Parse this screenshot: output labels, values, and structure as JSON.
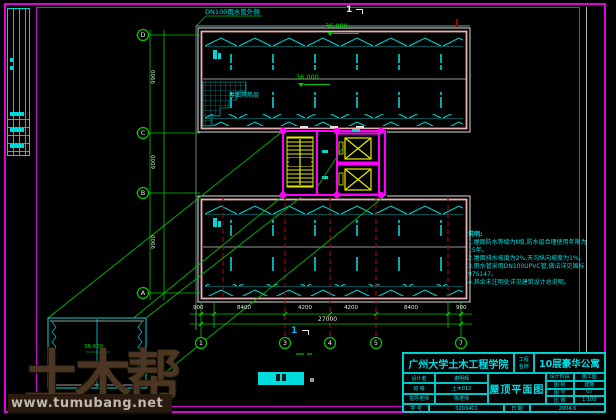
{
  "colors": {
    "background": "#000000",
    "frame_magenta": "#e000e0",
    "cad_cyan": "#00d8d8",
    "cad_green": "#00c800",
    "cad_yellow": "#e8e800",
    "cad_red": "#a00000",
    "cad_pink": "#e8b0b0",
    "watermark_brown": "#4d3824",
    "watermark_bar": "#2a1b0e"
  },
  "annotations": {
    "pipe_label": "DN100雨水管外侧",
    "section_mark_top": "1",
    "section_mark_bottom": "1",
    "elev_top": "36.000",
    "elev_mid": "36.000",
    "elev_detail": "36.600",
    "insulation_label": "屋面隔热层"
  },
  "grid": {
    "bottom_bubbles": [
      "1",
      "3",
      "4",
      "5",
      "7"
    ],
    "left_bubbles": [
      "D",
      "C",
      "B",
      "A"
    ]
  },
  "dimensions": {
    "bottom_segments": [
      "900",
      "8400",
      "4200",
      "4200",
      "8400",
      "900"
    ],
    "bottom_total": "27000",
    "left_segments": [
      "9900",
      "6000",
      "9900"
    ]
  },
  "notes": {
    "title": "说明:",
    "lines": [
      "1.屋面防水等级为Ⅱ级,防水层合理使用年限为15年。",
      "2.屋面排水坡度为2%,天沟纵向坡度为1%。",
      "3.雨水管采用DN100UPVC管,做法详见国标97S147。",
      "4.其余未注明处详见建筑设计总说明。"
    ]
  },
  "title_block": {
    "institution": "广州大学土木工程学院",
    "project_label_1": "工程",
    "project_label_2": "名称",
    "project_name": "10层豪华公寓",
    "drawing_title": "屋顶平面图",
    "scale_note": "1:100",
    "left_rows": [
      [
        "设计者",
        "谢明辉"
      ],
      [
        "班 级",
        "土木012"
      ],
      [
        "指导老师",
        "陈老师"
      ]
    ],
    "bottom_row": [
      [
        "学 号",
        "0203401"
      ],
      [
        "日 期",
        "2004.6"
      ]
    ],
    "right_rows": [
      [
        "设计阶段",
        "施工图"
      ],
      [
        "图 别",
        "建施"
      ],
      [
        "图 号",
        "07"
      ],
      [
        "比 例",
        "1:100"
      ]
    ]
  },
  "watermark": {
    "logo": "土木帮",
    "url": "www.tumubang.net"
  }
}
